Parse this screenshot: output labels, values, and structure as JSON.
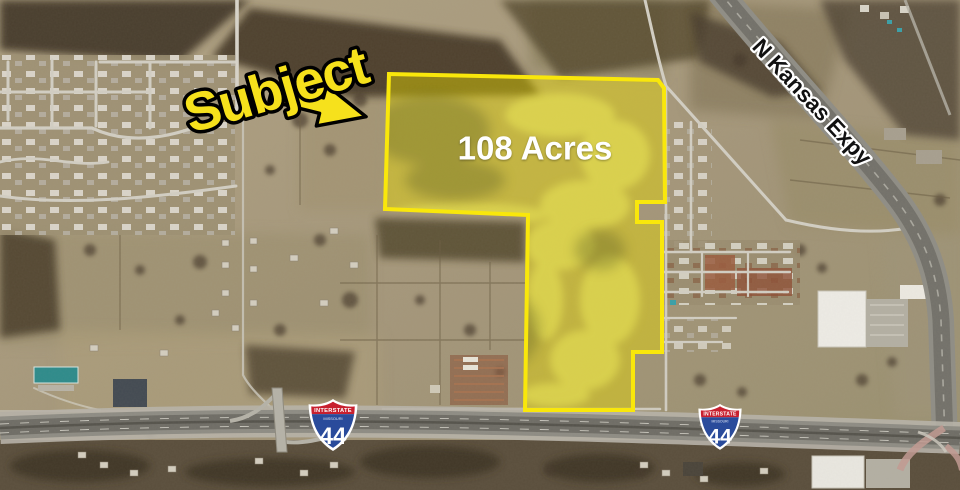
{
  "annotations": {
    "subject": "Subject",
    "acreage": "108 Acres",
    "road": "N Kansas Expy"
  },
  "shields": [
    {
      "header": "INTERSTATE",
      "state": "MISSOURI",
      "number": "44"
    },
    {
      "header": "INTERSTATE",
      "state": "MISSOURI",
      "number": "44"
    }
  ],
  "colors": {
    "annotation_yellow": "#f6e11c",
    "parcel_border": "#f9e70b",
    "label_white": "#ffffff",
    "road_label_black": "#111111",
    "shield_red": "#c8202f",
    "shield_blue": "#2a4b9b"
  }
}
